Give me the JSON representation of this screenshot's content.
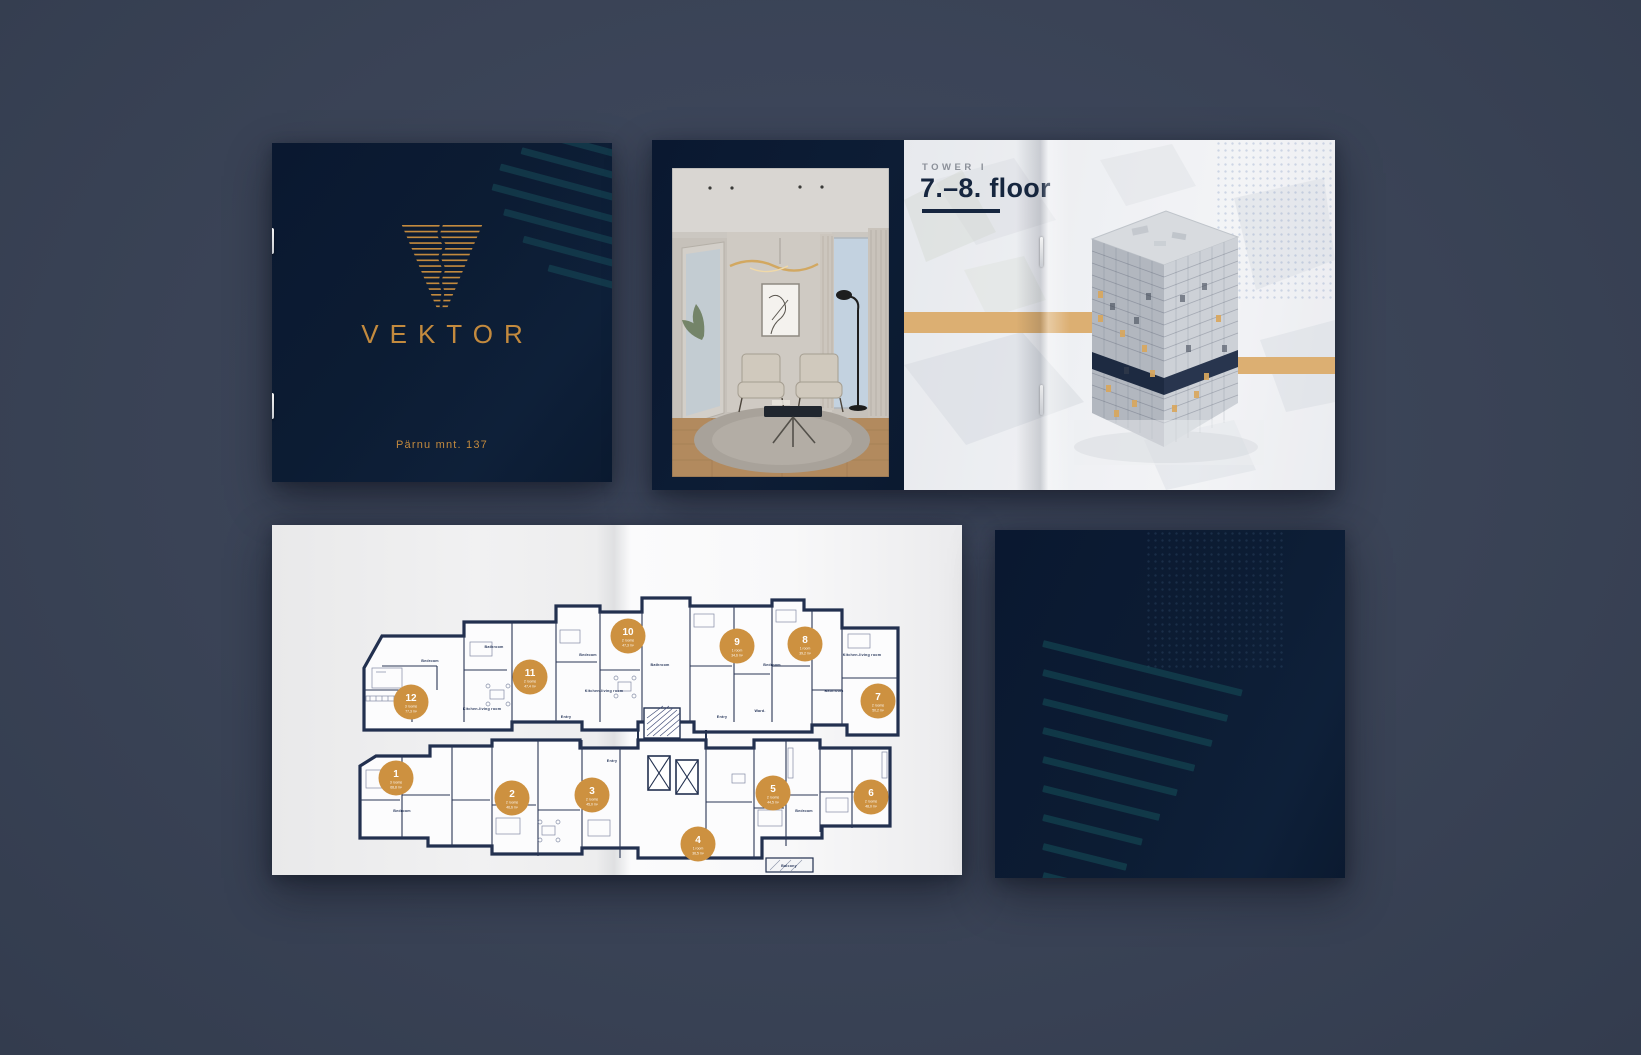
{
  "cover": {
    "brand": "VEKTOR",
    "address": "Pärnu mnt. 137",
    "gold": "#c38a3e",
    "navy": "#0b1a30",
    "teal_stripe": "#17505c"
  },
  "spread": {
    "eyebrow": "TOWER I",
    "title": "7.–8. floor",
    "band_color": "#dcaf72"
  },
  "floorplan": {
    "badge_color": "#cd9140",
    "ink_color": "#22304f",
    "apartments": [
      {
        "number": "1",
        "rooms": "3 rooms",
        "area": "68,8 m²"
      },
      {
        "number": "2",
        "rooms": "2 rooms",
        "area": "46,6 m²"
      },
      {
        "number": "3",
        "rooms": "2 rooms",
        "area": "45,0 m²"
      },
      {
        "number": "4",
        "rooms": "1 room",
        "area": "36,5 m²"
      },
      {
        "number": "5",
        "rooms": "2 rooms",
        "area": "44,5 m²"
      },
      {
        "number": "6",
        "rooms": "2 rooms",
        "area": "48,0 m²"
      },
      {
        "number": "7",
        "rooms": "2 rooms",
        "area": "50,2 m²"
      },
      {
        "number": "8",
        "rooms": "1 room",
        "area": "39,2 m²"
      },
      {
        "number": "9",
        "rooms": "1 room",
        "area": "34,6 m²"
      },
      {
        "number": "10",
        "rooms": "2 rooms",
        "area": "47,3 m²"
      },
      {
        "number": "11",
        "rooms": "2 rooms",
        "area": "47,4 m²"
      },
      {
        "number": "12",
        "rooms": "3 rooms",
        "area": "77,3 m²"
      }
    ],
    "room_labels": [
      "Bedroom",
      "Bathroom",
      "Kitchen-living room",
      "Entry",
      "Ward.",
      "Bedroom",
      "Bathroom",
      "Kitchen-living room",
      "Entry",
      "Bedroom",
      "Bathroom",
      "Kitchen-living room",
      "Bedroom",
      "Entry",
      "Balcony",
      "Bedroom"
    ]
  }
}
